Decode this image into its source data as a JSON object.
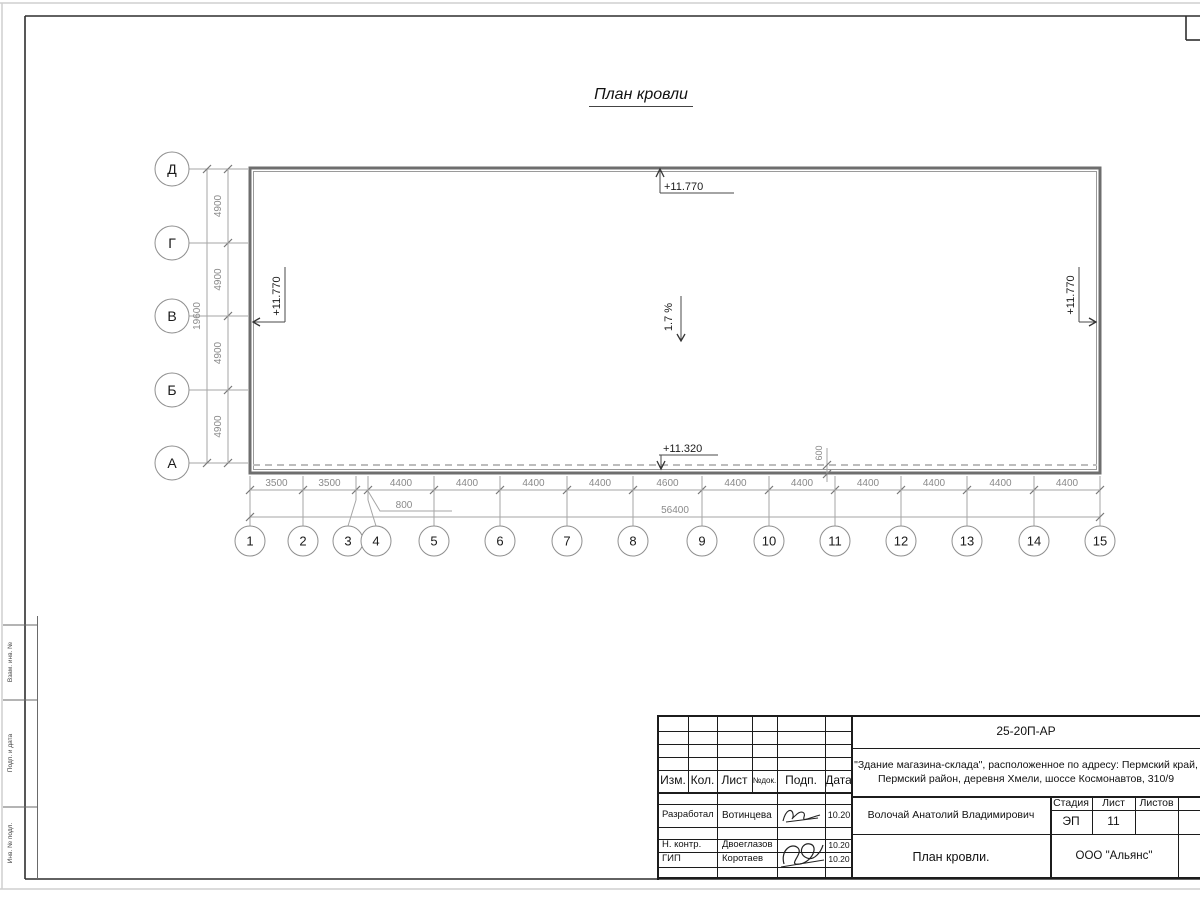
{
  "sheet": {
    "title": "План кровли"
  },
  "axes": {
    "rows": [
      "Д",
      "Г",
      "В",
      "Б",
      "А"
    ],
    "cols": [
      "1",
      "2",
      "3",
      "4",
      "5",
      "6",
      "7",
      "8",
      "9",
      "10",
      "11",
      "12",
      "13",
      "14",
      "15"
    ]
  },
  "dims": {
    "row_segments": [
      "4900",
      "4900",
      "4900",
      "4900"
    ],
    "row_total": "19600",
    "col_segments": [
      "3500",
      "3500",
      "800",
      "4400",
      "4400",
      "4400",
      "4400",
      "4600",
      "4400",
      "4400",
      "4400",
      "4400",
      "4400",
      "4400"
    ],
    "col_total": "56400",
    "eaves_offset": "600"
  },
  "marks": {
    "elev_top": "+11.770",
    "elev_left": "+11.770",
    "elev_right": "+11.770",
    "elev_eaves": "+11.320",
    "slope": "1.7 %"
  },
  "stamp": {
    "doc_code": "25-20П-АР",
    "object_line1": "\"Здание магазина-склада\", расположенное по адресу: Пермский край,",
    "object_line2": "Пермский район, деревня Хмели, шоссе Космонавтов, 310/9",
    "cols": [
      "Изм.",
      "Кол.",
      "Лист",
      "№док.",
      "Подп.",
      "Дата"
    ],
    "sign_rows": [
      {
        "role": "Разработал",
        "name": "Вотинцева",
        "date": "10.20"
      },
      {
        "role": "Н. контр.",
        "name": "Двоеглазов",
        "date": "10.20"
      },
      {
        "role": "ГИП",
        "name": "Коротаев",
        "date": "10.20"
      }
    ],
    "author": "Волочай Анатолий Владимирович",
    "stage_label": "Стадия",
    "sheet_label": "Лист",
    "sheets_label": "Листов",
    "stage": "ЭП",
    "sheet_no": "11",
    "sheets_total": "",
    "drawing_title": "План кровли.",
    "company": "ООО \"Альянс\""
  },
  "side_strip": {
    "labels": [
      "Взам. инв. №",
      "Подп. и дата",
      "Инв. № подл."
    ]
  },
  "colors": {
    "frame": "#2e2e2e",
    "roof_outline": "#6e6e6e",
    "dim_text": "#8a8a8a",
    "dashed_eaves": "#bdbdbd"
  }
}
